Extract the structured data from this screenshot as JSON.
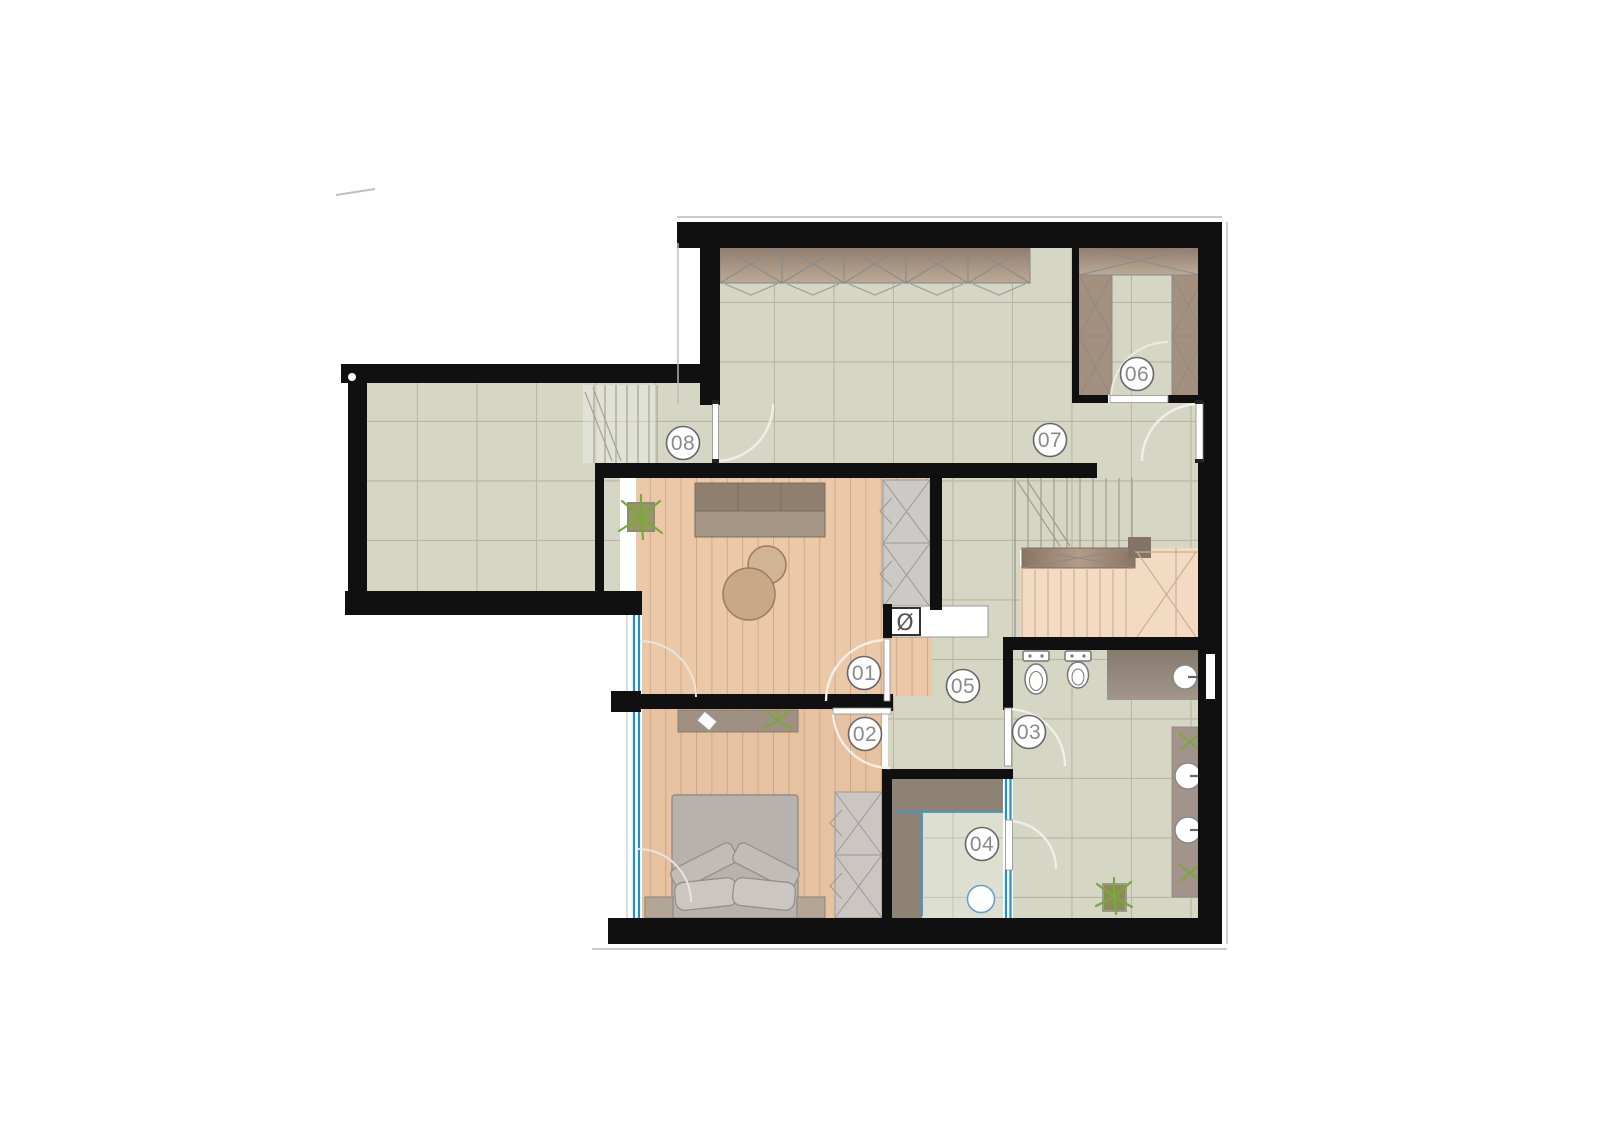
{
  "document": {
    "kind": "architectural floor plan",
    "background": "#ffffff"
  },
  "rooms": [
    {
      "label": "01"
    },
    {
      "label": "02"
    },
    {
      "label": "03"
    },
    {
      "label": "04"
    },
    {
      "label": "05"
    },
    {
      "label": "06"
    },
    {
      "label": "07"
    },
    {
      "label": "08"
    }
  ],
  "symbols": {
    "shaft": "Ø"
  },
  "colors": {
    "wall": "#101010",
    "tile_floor": "#d5d6c4",
    "wood_floor": "#eac8a8",
    "stair_wood": "#f3dac3",
    "wardrobe_brown": "#9d8a7a",
    "cabinet_gray": "#cdc9c6",
    "counter_taupe": "#8e8275",
    "glass_blue": "#2090c8",
    "plant_green": "#7fb23c",
    "label_gray": "#8a8a8a"
  }
}
